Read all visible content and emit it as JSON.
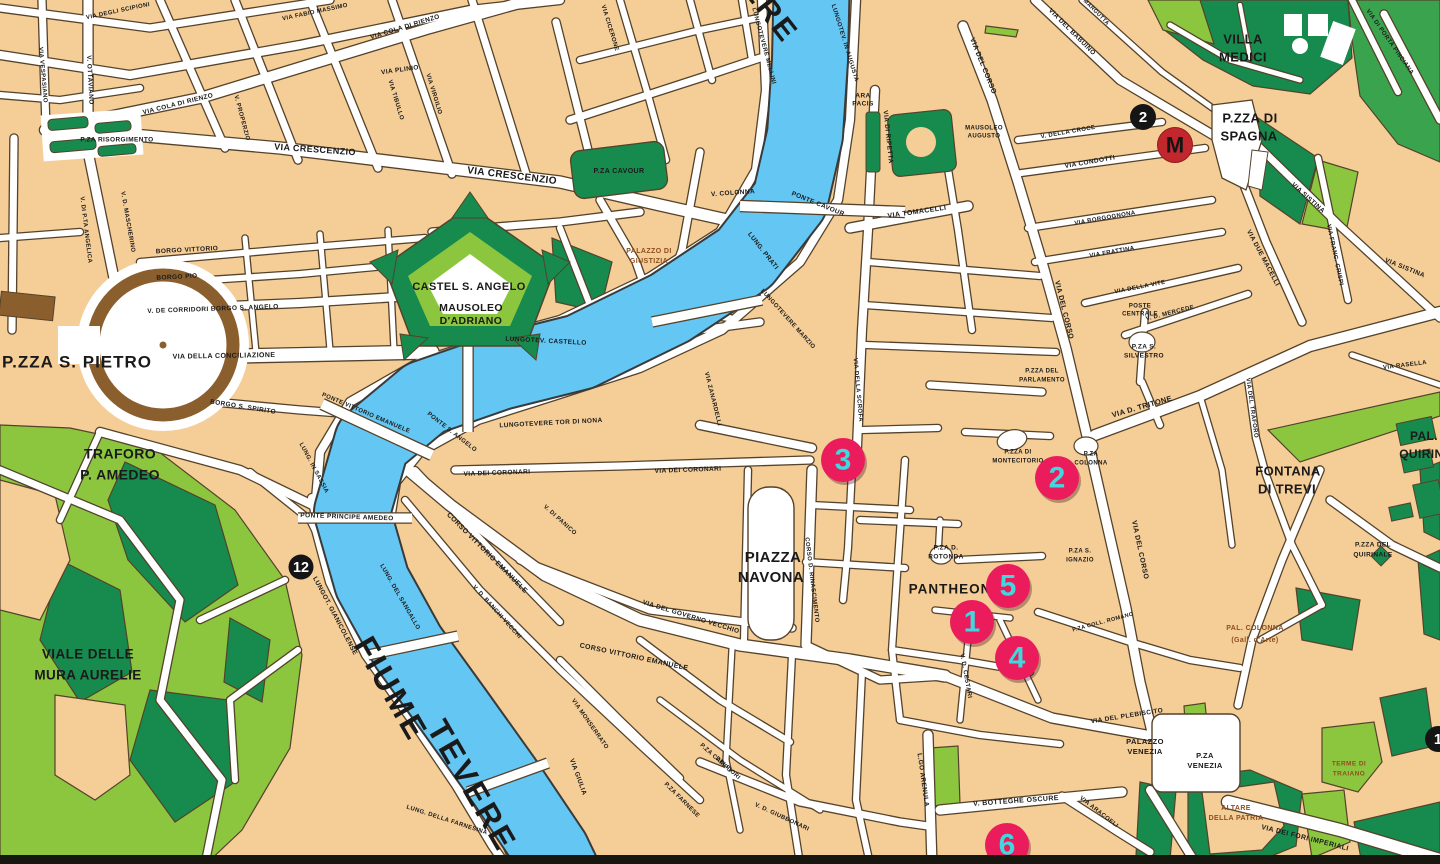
{
  "map": {
    "city": "Roma",
    "river_name": "FIUME TEVERE"
  },
  "colors": {
    "block": "#F5CD96",
    "street": "#FFFFFF",
    "outline": "#54422B",
    "river": "#63C6F3",
    "river_outline": "#3A3A3A",
    "park_dark": "#178A4E",
    "park_mid": "#3AA34D",
    "park_light": "#8CC63F",
    "colonnade": "#8B5E2E",
    "label": "#1A1A1A",
    "label_brown": "#8F4E1F",
    "sight_fill": "#EB1C5C",
    "sight_text": "#3FD8DF",
    "stop_fill": "#151515",
    "stop_text": "#FFFFFF",
    "metro_fill": "#C1272D",
    "metro_text": "#151515",
    "bottom_bar": "#17170F"
  },
  "markers": {
    "sights": [
      {
        "label": "3",
        "x": 843,
        "y": 460
      },
      {
        "label": "2",
        "x": 1057,
        "y": 478
      },
      {
        "label": "5",
        "x": 1008,
        "y": 586
      },
      {
        "label": "1",
        "x": 972,
        "y": 622
      },
      {
        "label": "4",
        "x": 1017,
        "y": 658
      },
      {
        "label": "6",
        "x": 1007,
        "y": 845
      }
    ],
    "stops": [
      {
        "label": "12",
        "x": 301,
        "y": 567,
        "r": 12.5
      },
      {
        "label": "2",
        "x": 1143,
        "y": 117,
        "r": 13
      },
      {
        "label": "1",
        "x": 1438,
        "y": 739,
        "r": 13
      }
    ],
    "metro": {
      "label": "M",
      "x": 1175,
      "y": 145,
      "r": 17.5
    }
  },
  "labels": [
    {
      "t": "P.ZZA S. PIETRO",
      "x": 77,
      "y": 363,
      "s": 17,
      "ls": 1
    },
    {
      "t": "TRAFORO",
      "x": 120,
      "y": 455,
      "s": 14
    },
    {
      "t": "P. AMEDEO",
      "x": 120,
      "y": 476,
      "s": 14
    },
    {
      "t": "VIALE DELLE",
      "x": 88,
      "y": 655,
      "s": 13.5
    },
    {
      "t": "MURA AURELIE",
      "x": 88,
      "y": 676,
      "s": 13.5
    },
    {
      "t": "CASTEL S. ANGELO",
      "x": 469,
      "y": 287,
      "s": 11
    },
    {
      "t": "MAUSOLEO",
      "x": 471,
      "y": 308,
      "s": 10.5
    },
    {
      "t": "D'ADRIANO",
      "x": 471,
      "y": 321,
      "s": 10.5
    },
    {
      "t": "PIAZZA",
      "x": 773,
      "y": 558,
      "s": 15
    },
    {
      "t": "NAVONA",
      "x": 771,
      "y": 578,
      "s": 15
    },
    {
      "t": "PANTHEON",
      "x": 950,
      "y": 590,
      "s": 13.5,
      "ls": 1
    },
    {
      "t": "VILLA",
      "x": 1243,
      "y": 40,
      "s": 13
    },
    {
      "t": "MEDICI",
      "x": 1243,
      "y": 58,
      "s": 13
    },
    {
      "t": "P.ZZA DI",
      "x": 1250,
      "y": 119,
      "s": 13
    },
    {
      "t": "SPAGNA",
      "x": 1249,
      "y": 137,
      "s": 13
    },
    {
      "t": "FONTANA",
      "x": 1288,
      "y": 472,
      "s": 13
    },
    {
      "t": "DI TREVI",
      "x": 1287,
      "y": 490,
      "s": 13
    },
    {
      "t": "PAL.",
      "x": 1424,
      "y": 437,
      "s": 12
    },
    {
      "t": "QUIRINALE",
      "x": 1434,
      "y": 455,
      "s": 12
    },
    {
      "t": "FIUME",
      "x": 389,
      "y": 690,
      "s": 32,
      "r": 60,
      "ls": 3
    },
    {
      "t": "TEVERE",
      "x": 470,
      "y": 787,
      "s": 32,
      "r": 60,
      "ls": 3
    },
    {
      "t": "TEVERE",
      "x": 748,
      "y": -14,
      "s": 30,
      "r": 52,
      "ls": 3
    },
    {
      "t": "P.ZA CAVOUR",
      "x": 619,
      "y": 171,
      "s": 7
    },
    {
      "t": "PALAZZO DI",
      "x": 649,
      "y": 251,
      "s": 7,
      "c": "brown"
    },
    {
      "t": "GIUSTIZIA",
      "x": 649,
      "y": 261,
      "s": 7,
      "c": "brown"
    },
    {
      "t": "ARA",
      "x": 863,
      "y": 96,
      "s": 6.5
    },
    {
      "t": "PACIS",
      "x": 863,
      "y": 104,
      "s": 6.5
    },
    {
      "t": "MAUSOLEO",
      "x": 984,
      "y": 128,
      "s": 6
    },
    {
      "t": "AUGUSTO",
      "x": 984,
      "y": 136,
      "s": 6
    },
    {
      "t": "P.ZA RISORGIMENTO",
      "x": 117,
      "y": 140,
      "s": 6.5
    },
    {
      "t": "P.ZZA DI",
      "x": 1018,
      "y": 452,
      "s": 6
    },
    {
      "t": "MONTECITORIO",
      "x": 1018,
      "y": 461,
      "s": 6
    },
    {
      "t": "P.ZA",
      "x": 1091,
      "y": 454,
      "s": 6
    },
    {
      "t": "COLONNA",
      "x": 1091,
      "y": 463,
      "s": 6
    },
    {
      "t": "P.ZZA DEL",
      "x": 1042,
      "y": 371,
      "s": 6
    },
    {
      "t": "PARLAMENTO",
      "x": 1042,
      "y": 380,
      "s": 6
    },
    {
      "t": "P.ZA S.",
      "x": 1144,
      "y": 347,
      "s": 6.5
    },
    {
      "t": "SILVESTRO",
      "x": 1144,
      "y": 356,
      "s": 6.5
    },
    {
      "t": "POSTE",
      "x": 1140,
      "y": 306,
      "s": 6
    },
    {
      "t": "CENTRALE",
      "x": 1140,
      "y": 314,
      "s": 6
    },
    {
      "t": "P.ZA D.",
      "x": 946,
      "y": 548,
      "s": 6.5
    },
    {
      "t": "ROTONDA",
      "x": 946,
      "y": 557,
      "s": 6.5
    },
    {
      "t": "P.ZA S.",
      "x": 1080,
      "y": 551,
      "s": 6
    },
    {
      "t": "IGNAZIO",
      "x": 1080,
      "y": 560,
      "s": 6
    },
    {
      "t": "P.ZZA DEL",
      "x": 1373,
      "y": 545,
      "s": 6.5
    },
    {
      "t": "QUIRINALE",
      "x": 1373,
      "y": 555,
      "s": 6.5
    },
    {
      "t": "PAL. COLONNA",
      "x": 1255,
      "y": 628,
      "s": 7,
      "c": "brown"
    },
    {
      "t": "(Gall. d'Arte)",
      "x": 1255,
      "y": 640,
      "s": 7,
      "c": "brown"
    },
    {
      "t": "PALAZZO",
      "x": 1145,
      "y": 742,
      "s": 7.5
    },
    {
      "t": "VENEZIA",
      "x": 1145,
      "y": 752,
      "s": 7.5
    },
    {
      "t": "P.ZA",
      "x": 1205,
      "y": 756,
      "s": 7.5
    },
    {
      "t": "VENEZIA",
      "x": 1205,
      "y": 766,
      "s": 7.5
    },
    {
      "t": "ALTARE",
      "x": 1236,
      "y": 808,
      "s": 7,
      "c": "brown"
    },
    {
      "t": "DELLA PATRIA",
      "x": 1236,
      "y": 818,
      "s": 7,
      "c": "brown"
    },
    {
      "t": "TERME DI",
      "x": 1349,
      "y": 764,
      "s": 6.5,
      "c": "brown"
    },
    {
      "t": "TRAIANO",
      "x": 1349,
      "y": 774,
      "s": 6.5,
      "c": "brown"
    },
    {
      "t": "VIA CRESCENZIO",
      "x": 315,
      "y": 150,
      "s": 9,
      "r": 4
    },
    {
      "t": "VIA CRESCENZIO",
      "x": 512,
      "y": 176,
      "s": 10,
      "r": 7
    },
    {
      "t": "VIA COLA DI RIENZO",
      "x": 178,
      "y": 104,
      "s": 6.5,
      "r": -14
    },
    {
      "t": "VIA COLA DI RIENZO",
      "x": 405,
      "y": 27,
      "s": 6.5,
      "r": -17
    },
    {
      "t": "VIA PLINIO",
      "x": 400,
      "y": 70,
      "s": 6.5,
      "r": -8
    },
    {
      "t": "VIA DEGLI SCIPIONI",
      "x": 118,
      "y": 11,
      "s": 6,
      "r": -12
    },
    {
      "t": "VIA FABIO MASSIMO",
      "x": 315,
      "y": 12,
      "s": 6,
      "r": -12
    },
    {
      "t": "V. OTTAVIANO",
      "x": 90,
      "y": 80,
      "s": 6.5,
      "r": 87
    },
    {
      "t": "VIA VESPASIANO",
      "x": 43,
      "y": 75,
      "s": 6,
      "r": 85
    },
    {
      "t": "V. PROPERZIO",
      "x": 242,
      "y": 118,
      "s": 6,
      "r": 75
    },
    {
      "t": "VIA TIBULLO",
      "x": 396,
      "y": 100,
      "s": 6,
      "r": 73
    },
    {
      "t": "VIA VIRGILIO",
      "x": 434,
      "y": 94,
      "s": 6,
      "r": 73
    },
    {
      "t": "V. D. MASCHERINO",
      "x": 128,
      "y": 222,
      "s": 6,
      "r": 80
    },
    {
      "t": "V. DI P.TA ANGELICA",
      "x": 86,
      "y": 230,
      "s": 6,
      "r": 83
    },
    {
      "t": "BORGO VITTORIO",
      "x": 187,
      "y": 250,
      "s": 6.5,
      "r": -3
    },
    {
      "t": "BORGO PIO",
      "x": 177,
      "y": 277,
      "s": 6.5,
      "r": -3
    },
    {
      "t": "V. DE CORRIDORI  BORGO S. ANGELO",
      "x": 213,
      "y": 309,
      "s": 6.5,
      "r": -2
    },
    {
      "t": "VIA DELLA CONCILIAZIONE",
      "x": 224,
      "y": 356,
      "s": 7,
      "r": -1
    },
    {
      "t": "BORGO S. SPIRITO",
      "x": 243,
      "y": 407,
      "s": 6.5,
      "r": 9
    },
    {
      "t": "LUNG. IN SASSIA",
      "x": 314,
      "y": 468,
      "s": 6,
      "r": 62
    },
    {
      "t": "PONTE VITTORIO EMANUELE",
      "x": 366,
      "y": 413,
      "s": 6,
      "r": 23
    },
    {
      "t": "PONTE PRINCIPE AMEDEO",
      "x": 347,
      "y": 517,
      "s": 6.5,
      "r": 2
    },
    {
      "t": "LUNGOT. GIANICOLENSE",
      "x": 335,
      "y": 616,
      "s": 6.5,
      "r": 62
    },
    {
      "t": "LUNG. DEL SANGALLO",
      "x": 400,
      "y": 597,
      "s": 6,
      "r": 60
    },
    {
      "t": "PONTE S. ANGELO",
      "x": 452,
      "y": 432,
      "s": 6,
      "r": 38
    },
    {
      "t": "LUNGOTEV. CASTELLO",
      "x": 546,
      "y": 341,
      "s": 6.5,
      "r": 3
    },
    {
      "t": "PONTE CAVOUR",
      "x": 818,
      "y": 204,
      "s": 6.5,
      "r": 22
    },
    {
      "t": "LUNG. PRATI",
      "x": 763,
      "y": 251,
      "s": 6.5,
      "r": 52
    },
    {
      "t": "LUNGOTEVERE MELLINI",
      "x": 764,
      "y": 46,
      "s": 6,
      "r": 75
    },
    {
      "t": "LUNGOTEV. IN AUGUSTA",
      "x": 845,
      "y": 43,
      "s": 6,
      "r": 73
    },
    {
      "t": "VIA CICERONE",
      "x": 610,
      "y": 28,
      "s": 6,
      "r": 73
    },
    {
      "t": "V. COLONNA",
      "x": 733,
      "y": 193,
      "s": 6.5,
      "r": -4
    },
    {
      "t": "LUNGOTEVERE MARZIO",
      "x": 788,
      "y": 319,
      "s": 6,
      "r": 48
    },
    {
      "t": "VIA ZANARDELLI",
      "x": 713,
      "y": 399,
      "s": 6,
      "r": 76
    },
    {
      "t": "LUNGOTEVERE TOR DI NONA",
      "x": 551,
      "y": 423,
      "s": 6.5,
      "r": -3
    },
    {
      "t": "VIA DEI CORONARI",
      "x": 497,
      "y": 473,
      "s": 6.5,
      "r": -2
    },
    {
      "t": "VIA DEI CORONARI",
      "x": 688,
      "y": 470,
      "s": 6.5,
      "r": -2
    },
    {
      "t": "V. DI PANICO",
      "x": 560,
      "y": 520,
      "s": 6,
      "r": 42
    },
    {
      "t": "CORSO VITTORIO EMANUELE",
      "x": 487,
      "y": 553,
      "s": 7,
      "r": 45
    },
    {
      "t": "CORSO VITTORIO EMANUELE",
      "x": 634,
      "y": 657,
      "s": 7,
      "r": 12
    },
    {
      "t": "V. D. BANCHI VECCHI",
      "x": 497,
      "y": 612,
      "s": 6,
      "r": 48
    },
    {
      "t": "VIA GIULIA",
      "x": 578,
      "y": 777,
      "s": 6.5,
      "r": 70
    },
    {
      "t": "VIA MONSERRATO",
      "x": 590,
      "y": 724,
      "s": 6,
      "r": 55
    },
    {
      "t": "VIA DEL GOVERNO VECCHIO",
      "x": 691,
      "y": 617,
      "s": 6.5,
      "r": 17
    },
    {
      "t": "P.ZA CAMPO",
      "x": 716,
      "y": 758,
      "s": 6,
      "r": 42
    },
    {
      "t": "DEI FIORI",
      "x": 728,
      "y": 768,
      "s": 6,
      "r": 42
    },
    {
      "t": "P.ZA FARNESE",
      "x": 682,
      "y": 800,
      "s": 6,
      "r": 45
    },
    {
      "t": "V. D. GIUBBONARI",
      "x": 782,
      "y": 817,
      "s": 6,
      "r": 25
    },
    {
      "t": "LUNG. DELLA FARNESINA",
      "x": 447,
      "y": 820,
      "s": 6,
      "r": 18
    },
    {
      "t": "CORSO D. RINASCIMENTO",
      "x": 812,
      "y": 580,
      "s": 6,
      "r": 83
    },
    {
      "t": "VIA DELLA SCROFA",
      "x": 858,
      "y": 390,
      "s": 6,
      "r": 85
    },
    {
      "t": "VIA DI RIPETTA",
      "x": 888,
      "y": 137,
      "s": 6.5,
      "r": 84
    },
    {
      "t": "VIA TOMACELLI",
      "x": 917,
      "y": 212,
      "s": 7,
      "r": -8
    },
    {
      "t": "VIA DEL CORSO",
      "x": 983,
      "y": 66,
      "s": 7,
      "r": 68
    },
    {
      "t": "VIA DEL CORSO",
      "x": 1064,
      "y": 310,
      "s": 7,
      "r": 76
    },
    {
      "t": "VIA DEL CORSO",
      "x": 1140,
      "y": 550,
      "s": 7,
      "r": 78
    },
    {
      "t": "VIA DEL BABUINO",
      "x": 1072,
      "y": 32,
      "s": 6.5,
      "r": 45
    },
    {
      "t": "VIA MARGUTTA",
      "x": 1092,
      "y": 8,
      "s": 5.5,
      "r": 45
    },
    {
      "t": "V. DELLA CROCE",
      "x": 1068,
      "y": 132,
      "s": 6,
      "r": -10
    },
    {
      "t": "VIA CONDOTTI",
      "x": 1090,
      "y": 162,
      "s": 6.5,
      "r": -10
    },
    {
      "t": "VIA BORGOGNONA",
      "x": 1105,
      "y": 218,
      "s": 6,
      "r": -10
    },
    {
      "t": "VIA FRATTINA",
      "x": 1112,
      "y": 252,
      "s": 6,
      "r": -10
    },
    {
      "t": "VIA DUE MACELLI",
      "x": 1263,
      "y": 258,
      "s": 6.5,
      "r": 62
    },
    {
      "t": "VIA FRANC. CRISPI",
      "x": 1335,
      "y": 255,
      "s": 6,
      "r": 78
    },
    {
      "t": "VIA SISTINA",
      "x": 1308,
      "y": 198,
      "s": 6.5,
      "r": 42
    },
    {
      "t": "VIA SISTINA",
      "x": 1405,
      "y": 268,
      "s": 6.5,
      "r": 22
    },
    {
      "t": "VIA DI PORTA PINCIANA",
      "x": 1390,
      "y": 42,
      "s": 6,
      "r": 55
    },
    {
      "t": "V. D. MERCEDE",
      "x": 1170,
      "y": 313,
      "s": 6,
      "r": -14
    },
    {
      "t": "VIA DELLA VITE",
      "x": 1140,
      "y": 287,
      "s": 6,
      "r": -11
    },
    {
      "t": "VIA D. TRITONE",
      "x": 1142,
      "y": 407,
      "s": 7.5,
      "r": -16
    },
    {
      "t": "VIA DEL TRAFORO",
      "x": 1252,
      "y": 408,
      "s": 6,
      "r": 82
    },
    {
      "t": "VIA RASELLA",
      "x": 1405,
      "y": 365,
      "s": 6,
      "r": -7
    },
    {
      "t": "P.ZA COLL. ROMANO",
      "x": 1103,
      "y": 622,
      "s": 5.5,
      "r": -15
    },
    {
      "t": "V. D. CESTARI",
      "x": 966,
      "y": 676,
      "s": 6,
      "r": 80
    },
    {
      "t": "VIA DEL PLEBISCITO",
      "x": 1127,
      "y": 716,
      "s": 6.5,
      "r": -9
    },
    {
      "t": "V. BOTTEGHE OSCURE",
      "x": 1016,
      "y": 801,
      "s": 7,
      "r": -4
    },
    {
      "t": "L.GO ARENULA",
      "x": 923,
      "y": 780,
      "s": 6.5,
      "r": 82
    },
    {
      "t": "VIA ARACOELI",
      "x": 1099,
      "y": 812,
      "s": 6,
      "r": 38
    },
    {
      "t": "VIA DEI FORI IMPERIALI",
      "x": 1305,
      "y": 838,
      "s": 7,
      "r": 14
    }
  ]
}
